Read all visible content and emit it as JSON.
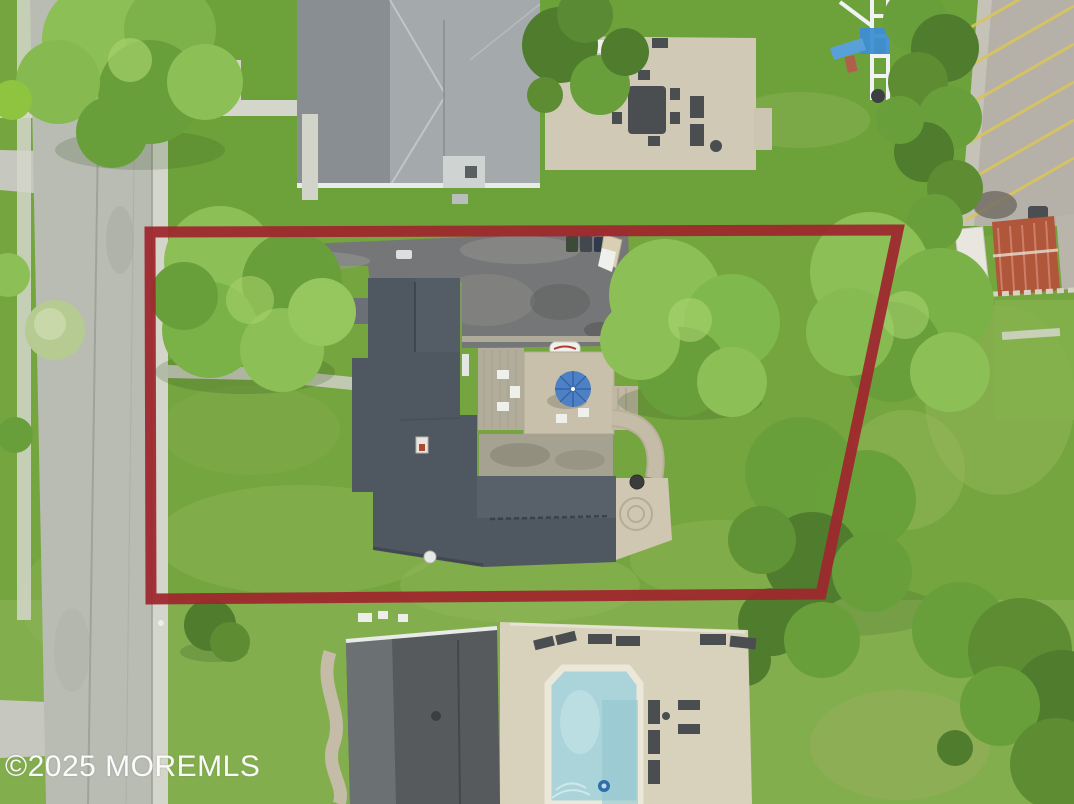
{
  "watermark": {
    "text": "©2025 MOREMLS",
    "color": "#ffffff"
  },
  "boundary": {
    "color": "#9e272e",
    "stroke_width": 11
  },
  "colors": {
    "grass_base": "#75a53f",
    "grass_top": "#6da23a",
    "grass_bottom": "#83ae4e",
    "grass_pale": "#96b95e",
    "road": "#b9bcb3",
    "sidewalk": "#d4d6cb",
    "concrete_apron": "#c6c7be",
    "driveway_asphalt": "#757677",
    "driveway_worn": "#9a9b95",
    "roof_main": "#4f5760",
    "roof_main_light": "#5d656d",
    "roof_top_neighbor": "#a4a9ac",
    "roof_top_neighbor_dark": "#7f8588",
    "roof_bottom_neighbor": "#565a5d",
    "roof_bottom_neighbor_light": "#707578",
    "deck_wood": "#b2ac9a",
    "stone_patio": "#c8c0aa",
    "patio_weathered": "#a6a291",
    "paver_path": "#c4bca6",
    "pool_patio": "#d8d1bb",
    "pool_water": "#aad3da",
    "pool_coping": "#ebe8da",
    "umbrella_blue": "#4d80c4",
    "slide_blue": "#3f8ed2",
    "playground_white": "#f0f2f4",
    "parking_asphalt": "#b5b1a8",
    "parking_stripe": "#d8c45c",
    "rust_roof": "#b0563a",
    "tree_bright": "#8cbf55",
    "tree_mid": "#699f3b",
    "tree_dark": "#4f7c2d",
    "tree_pale": "#b5cb92",
    "furniture_dark": "#4a4e50",
    "furniture_white": "#eff0ec"
  }
}
